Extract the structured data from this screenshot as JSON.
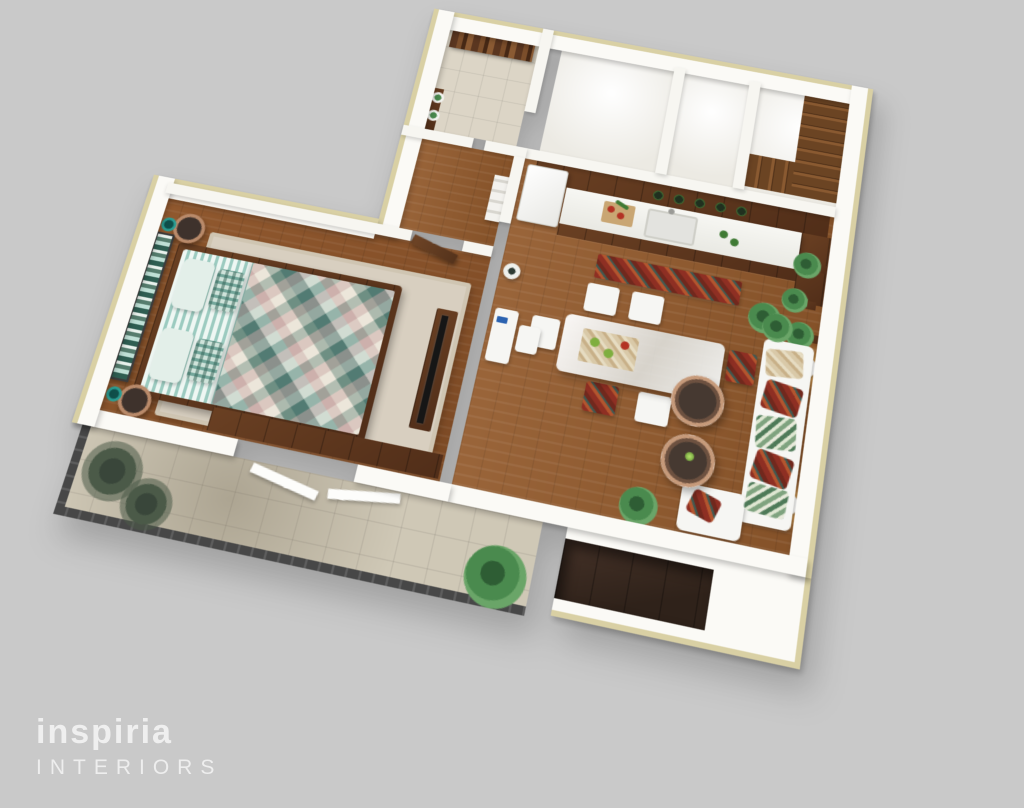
{
  "image": {
    "type": "3d-floor-plan-render",
    "view": "axonometric top-down apartment visualization",
    "background_color": "#c9c9c9"
  },
  "logo": {
    "brand": "inspiria",
    "tagline": "INTERIORS",
    "color": "#f2f2f2"
  },
  "palette": {
    "background": "#c9c9c9",
    "wall_white": "#fbfaf6",
    "wall_top_cream": "#d9d0a4",
    "wood_floor": "#9a653a",
    "cabinet_wood": "#6a4023",
    "tile_floor": "#dcd5c6",
    "balcony_tile": "#cfc8b6",
    "railing": "#474747",
    "sofa_white": "#f6f6f3",
    "accent_red": "#8e2f23",
    "accent_teal": "#74a79b",
    "plant_green": "#4a8a4e",
    "lamp_glow": "#ffc86e"
  },
  "scene": {
    "rooms": [
      {
        "name": "entry-hall",
        "floor": "beige tile",
        "items": [
          "wooden wall art",
          "console with two white plant pots"
        ]
      },
      {
        "name": "bathroom",
        "floor": "white",
        "items": []
      },
      {
        "name": "utility-room",
        "floor": "white",
        "items": []
      },
      {
        "name": "staircase-room",
        "floor": "white",
        "items": [
          "L-shaped wooden staircase"
        ]
      },
      {
        "name": "kitchen",
        "floor": "wood",
        "items": [
          "upper cabinets",
          "white refrigerator",
          "counter with sink",
          "cutting board with vegetables",
          "green-lid jars",
          "red runner rug",
          "tall cabinet"
        ]
      },
      {
        "name": "dining-area",
        "floor": "wood",
        "items": [
          "glass-top dining table",
          "white upholstered chairs",
          "patterned chairs",
          "placemat with green apples"
        ]
      },
      {
        "name": "living-area",
        "floor": "wood",
        "items": [
          "white sofa with patterned cushions",
          "chaise with red pillow",
          "two round coffee tables",
          "white desk and chair",
          "ladder shelf",
          "round vase",
          "wall sconces with warm glow",
          "wall plant shelves",
          "potted plants"
        ]
      },
      {
        "name": "bedroom",
        "floor": "wood",
        "items": [
          "double bed with teal patchwork quilt",
          "striped teal bedding",
          "pillows",
          "striped green headboard artwork",
          "two copper bowl side tables",
          "teal table lamps",
          "beige area rug",
          "TV console",
          "wardrobe"
        ]
      },
      {
        "name": "balcony",
        "floor": "tile",
        "items": [
          "dark railing",
          "palm plants",
          "white door leaves",
          "large potted plant"
        ]
      },
      {
        "name": "exterior-recess",
        "floor": "dark wood panels",
        "items": []
      }
    ]
  }
}
